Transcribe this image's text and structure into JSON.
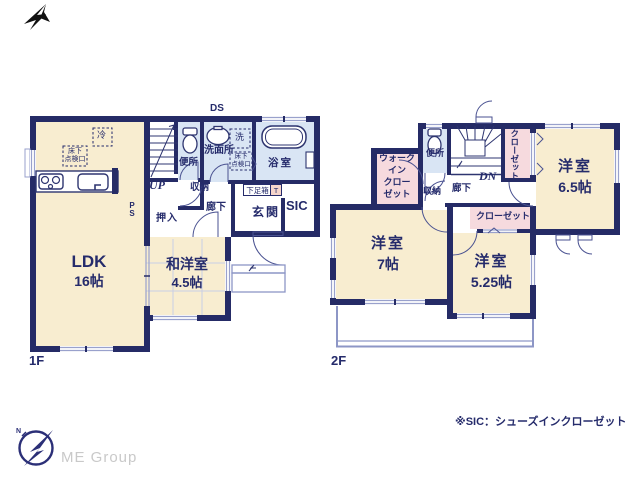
{
  "doc": {
    "type": "floor-plan",
    "floor1_label": "1F",
    "floor2_label": "2F",
    "note": "※SIC：シューズインクローゼット"
  },
  "f1": {
    "ldk_name": "LDK",
    "ldk_size": "16帖",
    "washitsu_name": "和洋室",
    "washitsu_size": "4.5帖",
    "oshiire": "押入",
    "toilet": "便所",
    "washroom": "洗面所",
    "washer": "洗",
    "bath": "浴室",
    "fridge": "冷",
    "floor_hatch": "床下\n点検口",
    "storage": "収納",
    "hallway": "廊下",
    "shoebox": "下足箱",
    "shoebox_t": "T",
    "entrance": "玄関",
    "sic": "SIC",
    "up": "UP",
    "ds": "DS",
    "ps": "P\nS"
  },
  "f2": {
    "toilet": "便所",
    "dn": "DN",
    "closet": "クローゼット",
    "wic": "ウォーク\nイン\nクロー\nゼット",
    "storage": "収納",
    "hallway": "廊下",
    "room65_name": "洋室",
    "room65_size": "6.5帖",
    "room7_name": "洋室",
    "room7_size": "7帖",
    "room525_name": "洋室",
    "room525_size": "5.25帖"
  },
  "footer": {
    "logo_text": "ME Group",
    "logo_n": "N"
  },
  "colors": {
    "wall_navy": "#252b66",
    "room_cream": "#f8edd0",
    "wet_blue": "#d9e5f4",
    "closet_pink": "#f6dade",
    "text_navy": "#252b6b",
    "t_box": "#f5d5cb",
    "light_line": "#99a1cc",
    "logo_gray": "#c9c9c9"
  }
}
